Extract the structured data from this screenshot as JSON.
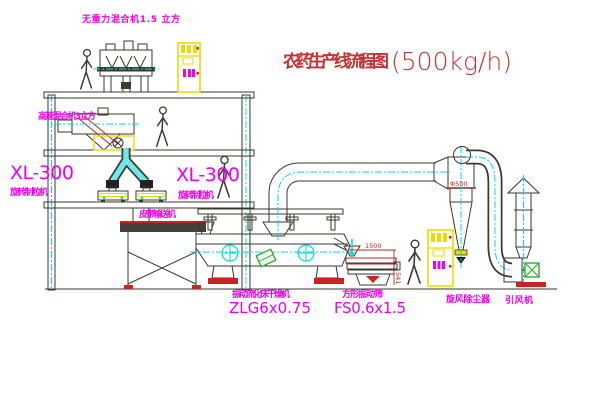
{
  "title": {
    "text": "农药生产线流程图",
    "capacity": "(500kg/h)"
  },
  "equipment": {
    "gravity_mixer": {
      "label": "无重力混合机1.5 立方"
    },
    "high_speed_mixer": {
      "label": "高速混合机3立方"
    },
    "granulator_left": {
      "model": "XL-300",
      "label": "旋转制粒机"
    },
    "granulator_mid": {
      "model": "XL-300",
      "label": "旋转制粒机"
    },
    "belt_conveyor": {
      "label": "皮带输送机"
    },
    "fluid_bed_dryer": {
      "label": "振动流化床干燥机",
      "model": "ZLG6x0.75"
    },
    "square_sieve": {
      "label": "方形振动筛",
      "model": "FS0.6x1.5"
    },
    "cyclone": {
      "label": "旋风除尘器",
      "dimension": "Φ500"
    },
    "fan": {
      "label": "引风机"
    }
  },
  "dimensions": {
    "sieve_length": "1500",
    "sieve_height": "541"
  },
  "colors": {
    "label_magenta": "#f000f0",
    "title_red": "#c83232",
    "line_dark": "#3a3a2e",
    "centerline_cyan": "#00dede",
    "cabinet_yellow": "#e8dc00",
    "accent_red": "#cc2222",
    "motor_green": "#2f9e2f"
  }
}
